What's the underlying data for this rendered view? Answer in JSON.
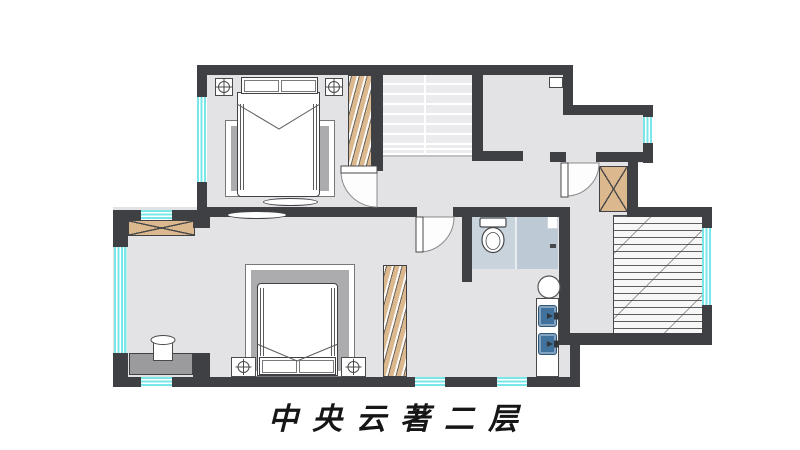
{
  "title": {
    "text": "中央云著二层"
  },
  "colors": {
    "wall": "#3e4043",
    "floor": "#e3e3e5",
    "window_glass": "#79e7e9",
    "wardrobe_wood": "#dcb88f",
    "bath_floor": "#c9d3db",
    "shower_floor": "#bdc9d4",
    "sink_basin": "#41729e",
    "rug": "#acacae",
    "desk": "#9b9b9d"
  },
  "floorplan": {
    "rooms": [
      "bedroom-top",
      "bedroom-bottom",
      "bay-alcove",
      "hall",
      "stair-well",
      "corridor",
      "toilet-room",
      "shower-area",
      "vanity-nook",
      "laundry-passage",
      "balcony"
    ],
    "fixtures": [
      "double-bed",
      "pillows",
      "nightstand",
      "rug",
      "tv-console",
      "hanger-wardrobe",
      "x-cabinet",
      "desk",
      "chair",
      "toilet",
      "twin-sink-vanity",
      "round-stool",
      "stairs",
      "window",
      "door-swing"
    ]
  }
}
